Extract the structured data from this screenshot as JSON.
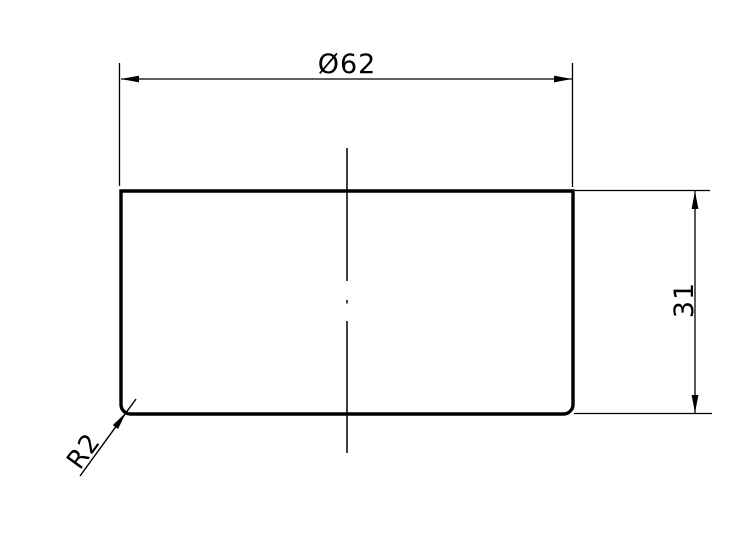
{
  "drawing": {
    "type": "technical-drawing",
    "description": "Cross-section of a cylindrical cap part with dimensions",
    "labels": {
      "diameter": "Ø62",
      "height": "31",
      "corner_radius": "R2"
    },
    "part": {
      "diameter_mm": 62,
      "height_mm": 31,
      "corner_radius_mm": 2
    },
    "colors": {
      "line": "#000000",
      "background": "#ffffff"
    }
  }
}
